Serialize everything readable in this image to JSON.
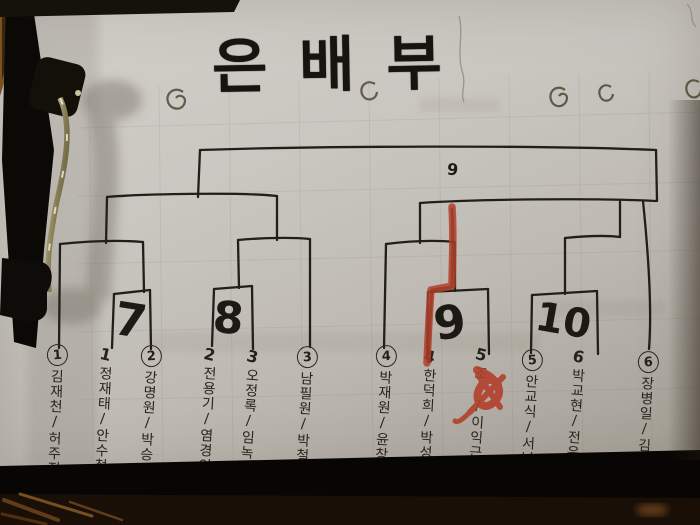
{
  "title": "은배부",
  "bracket": {
    "round1_match_numbers": [
      "7",
      "8",
      "9",
      "10"
    ],
    "final_mark": "9",
    "teams": [
      {
        "seed": "1",
        "circled": true,
        "players": "김재천/허주진"
      },
      {
        "seed": "1",
        "circled": false,
        "players": "정재태/안수철"
      },
      {
        "seed": "2",
        "circled": true,
        "players": "강명원/박승민"
      },
      {
        "seed": "2",
        "circled": false,
        "players": "전용기/염경인"
      },
      {
        "seed": "3",
        "circled": false,
        "players": "오정록/임녹연"
      },
      {
        "seed": "3",
        "circled": true,
        "players": "남필원/박철모"
      },
      {
        "seed": "4",
        "circled": true,
        "players": "박재원/윤창석"
      },
      {
        "seed": "4",
        "circled": false,
        "players": "한덕희/박성수"
      },
      {
        "seed": "5",
        "circled": false,
        "players": "조 /이익근"
      },
      {
        "seed": "5",
        "circled": true,
        "players": "안교식/서남기"
      },
      {
        "seed": "6",
        "circled": false,
        "players": "박교현/전윤원"
      },
      {
        "seed": "6",
        "circled": true,
        "players": "장병일/김청천"
      }
    ]
  },
  "annotations": {
    "red_marker_color": "#b2402c",
    "ink_color": "#221f1a"
  },
  "colors": {
    "paper": "#c7c4be",
    "table_dark": "#0b0805",
    "wood_grain": "#6e451d"
  }
}
